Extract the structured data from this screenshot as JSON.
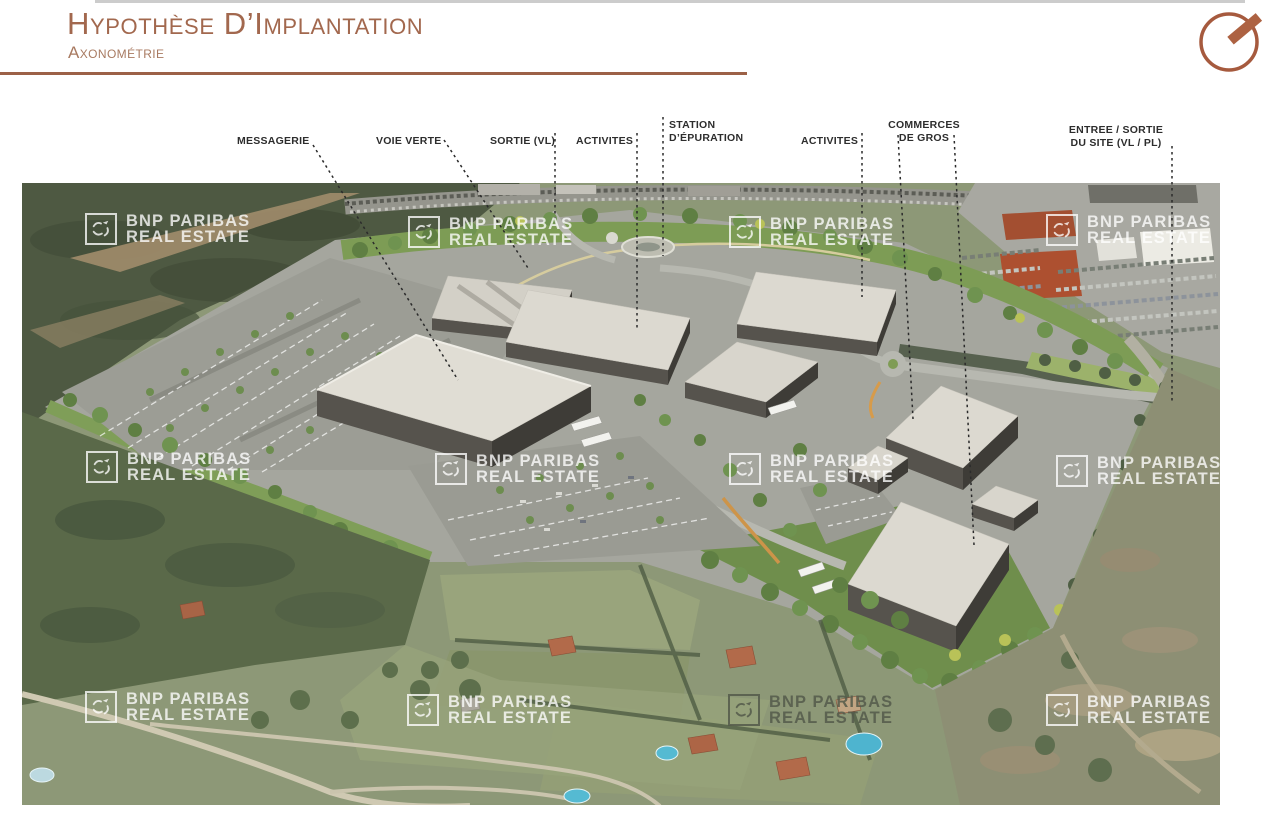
{
  "page": {
    "background": "#ffffff",
    "top_border_color": "#cccccc"
  },
  "header": {
    "title": "Hypothèse D’Implantation",
    "subtitle": "Axonométrie",
    "accent_color": "#a2684e",
    "rule_color": "#9c6147",
    "compass_icon_color": "#a65a3e"
  },
  "annotations": {
    "label_color": "#2d2d2d",
    "labels": [
      {
        "id": "messagerie",
        "lines": [
          "MESSAGERIE"
        ]
      },
      {
        "id": "voie-verte",
        "lines": [
          "VOIE VERTE"
        ]
      },
      {
        "id": "sortie-vl",
        "lines": [
          "SORTIE (VL)"
        ]
      },
      {
        "id": "activites-1",
        "lines": [
          "ACTIVITES"
        ]
      },
      {
        "id": "station-epuration",
        "lines": [
          "STATION",
          "D’ÉPURATION"
        ]
      },
      {
        "id": "activites-2",
        "lines": [
          "ACTIVITES"
        ]
      },
      {
        "id": "commerces-de-gros",
        "lines": [
          "COMMERCES",
          "DE GROS"
        ]
      },
      {
        "id": "entree-sortie",
        "lines": [
          "ENTREE / SORTIE",
          "DU SITE (VL / PL)"
        ]
      }
    ]
  },
  "watermark": {
    "line1": "BNP PARIBAS",
    "line2": "REAL ESTATE",
    "light_color": "rgba(255,255,255,0.78)",
    "dark_color": "rgba(84,89,74,0.85)"
  }
}
